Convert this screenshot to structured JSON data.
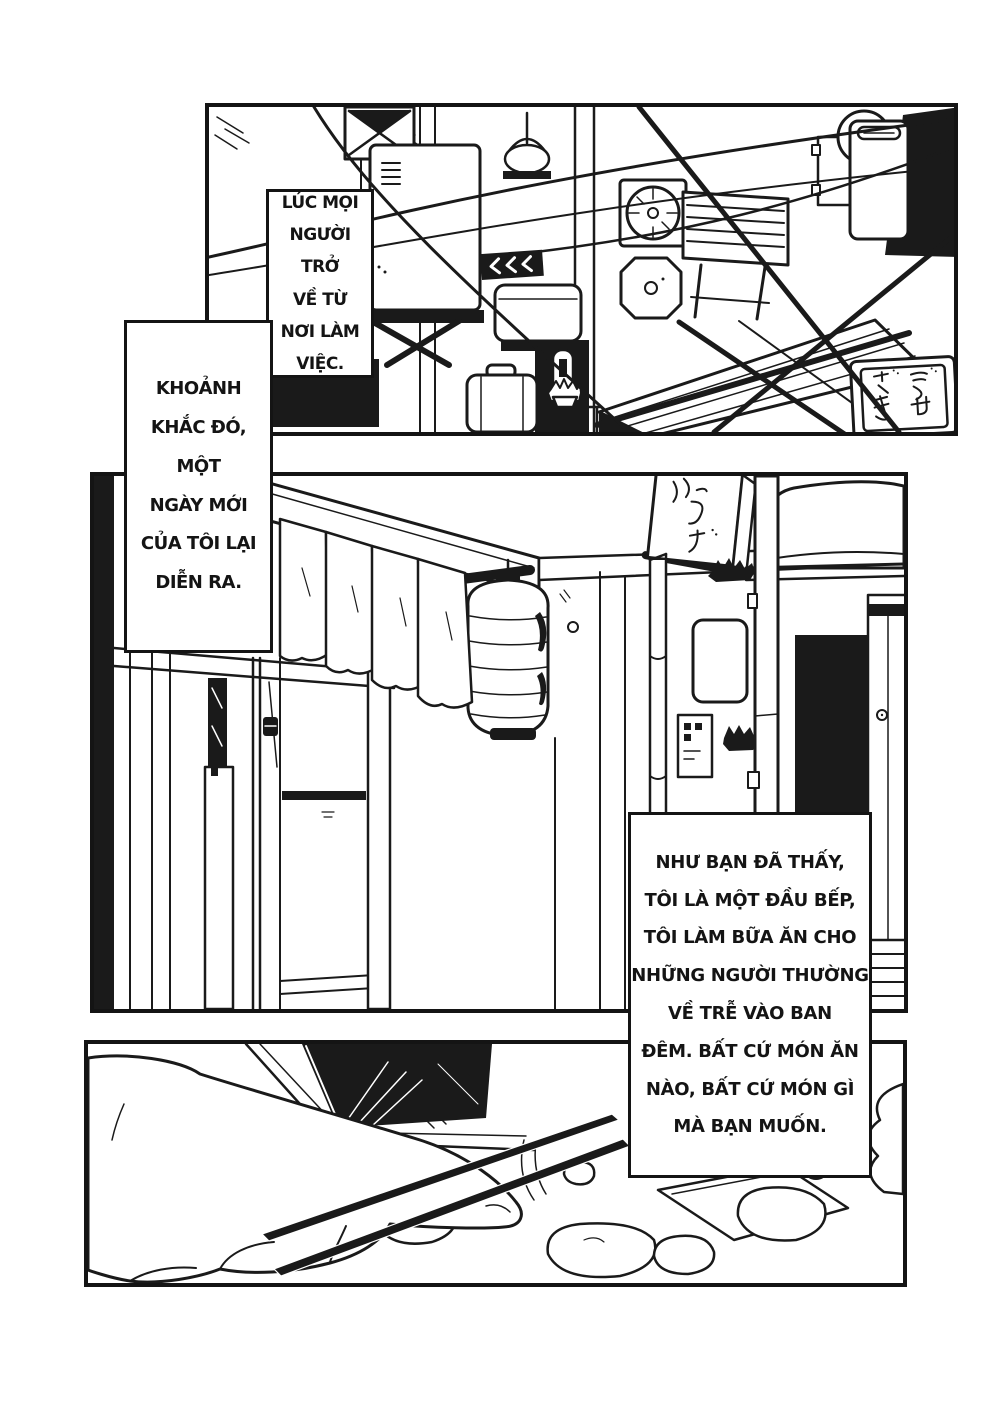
{
  "page": {
    "kind": "black-and-white manga page",
    "background_color": "#ffffff",
    "ink_color": "#1a1a1a",
    "language": "Vietnamese"
  },
  "captions": [
    {
      "id": "caption-1",
      "text": "LÚC MỌI\nNGƯỜI TRỞ\nVỀ TỪ\nNƠI LÀM\nVIỆC."
    },
    {
      "id": "caption-2",
      "text": "KHOẢNH\nKHẮC ĐÓ, MỘT\nNGÀY MỚI\nCỦA TÔI LẠI\nDIỄN RA."
    },
    {
      "id": "caption-3",
      "text": "NHƯ BẠN ĐÃ THẤY,\nTÔI LÀ MỘT ĐẦU BẾP,\nTÔI LÀM BỮA ĂN CHO\nNHỮNG NGƯỜI THƯỜNG\nVỀ TRỄ VÀO BAN\nĐÊM. BẤT CỨ MÓN ĂN\nNÀO, BẤT CỨ MÓN GÌ\nMÀ BẠN MUỐN."
    }
  ],
  "panels": [
    {
      "id": "panel-1",
      "description": "Back-alley scene: wall heater, hanging kettle, exhaust fans, slatted shutter, power lines, tiled roof, old TV sign with Japanese writing"
    },
    {
      "id": "panel-2",
      "description": "Izakaya storefront: noren curtain, paper lantern, hanging shop sign, sliding doors, pole, shrubs, veranda with futon"
    },
    {
      "id": "panel-3",
      "description": "Close-up of a hand holding chopsticks over a tray of food"
    }
  ],
  "signs": {
    "roof_sign_japanese": "ご せ だ き",
    "storefront_sign_japanese": "う ど"
  }
}
